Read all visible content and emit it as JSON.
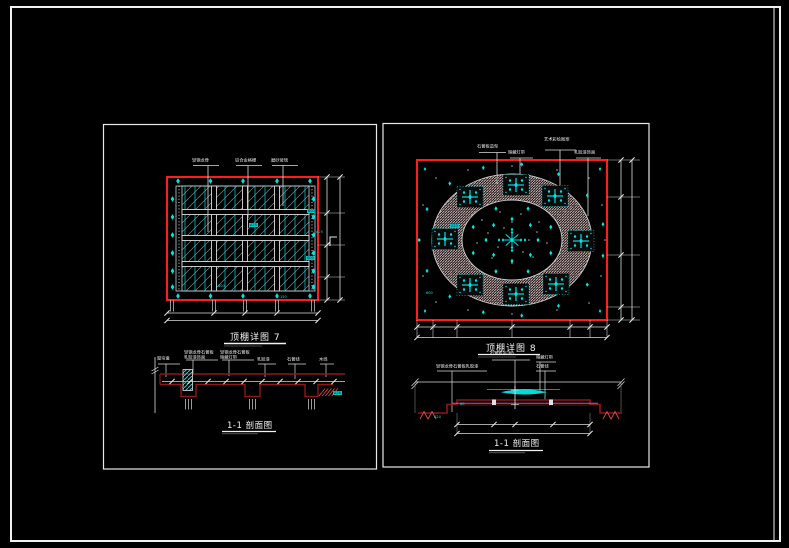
{
  "colors": {
    "background": "#000000",
    "sheet_frame": "#f0f0f0",
    "plan_border_red": "#ff1c1c",
    "section_line_maroon": "#8e1818",
    "ornament_cyan": "#00e0e0",
    "ring_hatch_pink": "#dcc0c0",
    "magenta_line": "#b75ab7"
  },
  "left_panel": {
    "plan": {
      "title": "顶棚详图 7",
      "callouts": [
        "轻钢龙骨",
        "铝合金格栅",
        "磨砂玻璃"
      ],
      "tags": {
        "right_top": "600",
        "right_mid": "A25",
        "right_bottom": "600",
        "center": "A25",
        "bottom_left": "600",
        "bottom_right": "150"
      }
    },
    "section": {
      "title": "1-1 剖面图",
      "callouts": [
        "窗帘盒",
        "轻钢龙骨石膏板乳胶漆饰面",
        "轻钢龙骨石膏板暗藏灯带",
        "乳胶漆",
        "石膏线",
        "木线"
      ],
      "tags": {
        "block": "A26"
      }
    }
  },
  "right_panel": {
    "plan": {
      "title": "顶棚详图 8",
      "callouts": [
        "石膏板造型",
        "暗藏灯带",
        "艺术彩绘图案",
        "乳胶漆饰面"
      ],
      "tags": {
        "ring_left": "A23",
        "bottom_left": "600"
      }
    },
    "section": {
      "title": "1-1 剖面图",
      "callouts": [
        "石膏板吊顶6",
        "轻钢龙骨石膏板乳胶漆",
        "暗藏灯带",
        "石膏线"
      ],
      "tags": {
        "platform": "60",
        "end": "A24"
      }
    }
  }
}
